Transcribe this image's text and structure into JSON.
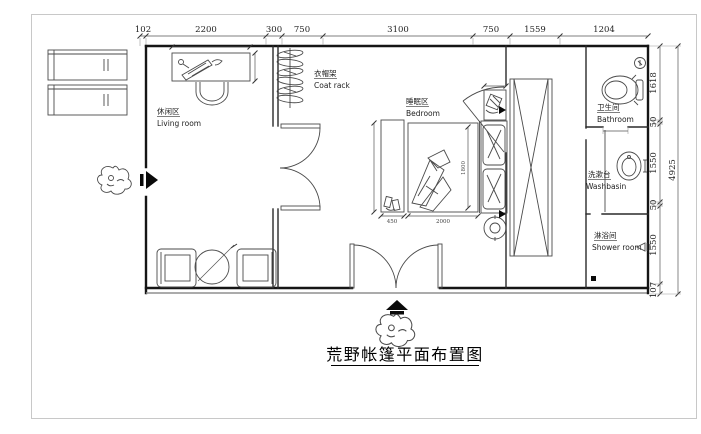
{
  "title": {
    "text": "荒野帐篷平面布置图"
  },
  "dimensions": {
    "top": [
      "102",
      "2200",
      "300",
      "750",
      "3100",
      "750",
      "1559",
      "1204"
    ],
    "right": [
      "1618",
      "50",
      "1550",
      "50",
      "1550",
      "107"
    ],
    "right_overall": "4925",
    "bench_width": "450",
    "bed_width": "2000",
    "bed_length": "1800"
  },
  "rooms": {
    "living": {
      "zh": "休闲区",
      "en": "Living room"
    },
    "coat": {
      "zh": "衣帽架",
      "en": "Coat rack"
    },
    "bedroom": {
      "zh": "睡眠区",
      "en": "Bedroom"
    },
    "bathroom": {
      "zh": "卫生间",
      "en": "Bathroom"
    },
    "washbasin": {
      "zh": "洗漱台",
      "en": "Washbasin"
    },
    "shower": {
      "zh": "淋浴间",
      "en": "Shower room"
    }
  },
  "icons": {
    "entry-arrow-icon": "solid black arrow marking entrance",
    "plant-icon": "shrub sketch at entrances",
    "coat-hanger-icon": "hangers on rail",
    "toilet-icon": "toilet plan symbol",
    "washbasin-icon": "oval basin symbol",
    "shower-head-icon": "shower symbol",
    "floor-drain-icon": "black square drain",
    "wardrobe-x-icon": "crossed rectangle wardrobe"
  },
  "colors": {
    "wall": "#151515",
    "furniture_line": "#4a4a4a",
    "dimension_line": "#555555",
    "frame": "#c8c8c8",
    "background": "#ffffff"
  }
}
